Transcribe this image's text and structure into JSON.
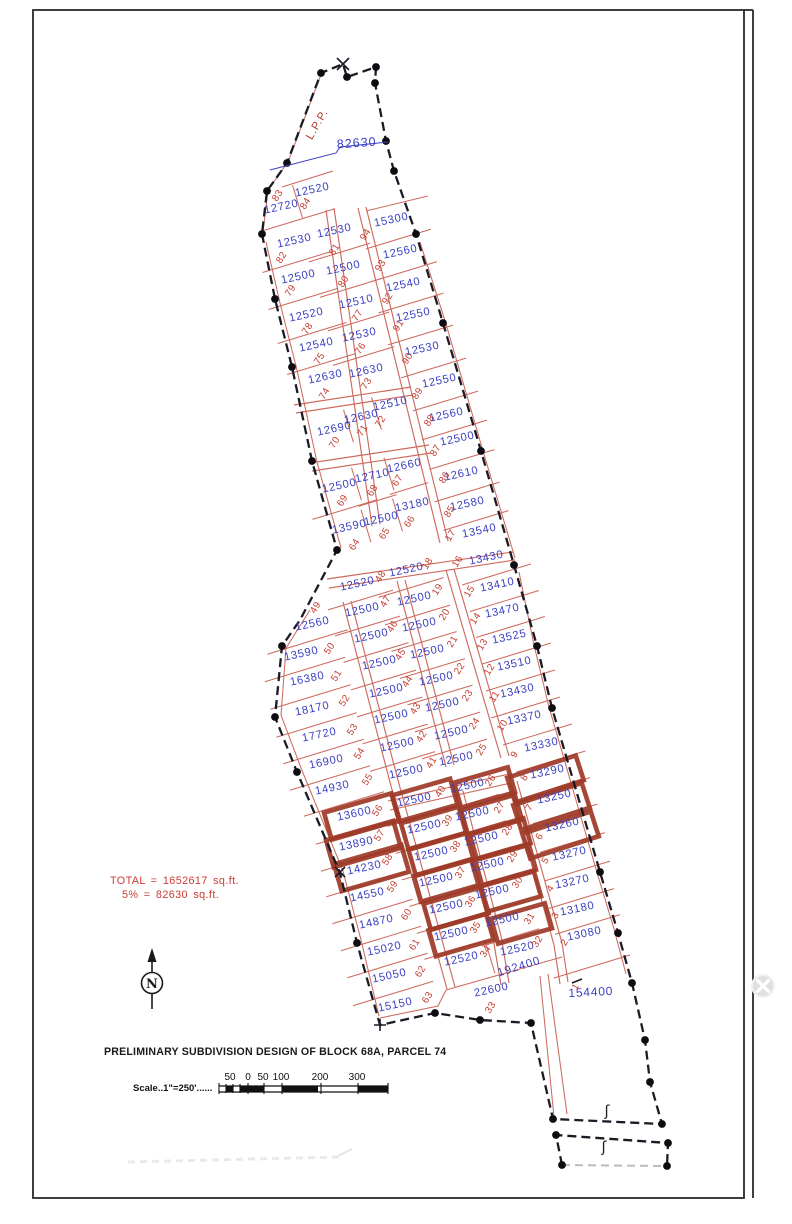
{
  "drawing": {
    "title": "PRELIMINARY  SUBDIVISION  DESIGN  OF  BLOCK  68A,  PARCEL  74",
    "scale_label": "Scale..1\"=250'......",
    "total_line1": "TOTAL  =  1652617  sq.ft.",
    "total_line2": "5%  =  82630  sq.ft.",
    "lpp_label": "L.P.P.",
    "top_area_label": "82630",
    "area_192400": "192400",
    "north_label": "N",
    "section_symbol": "ʃ"
  },
  "colors": {
    "lot_line": "#cd6a5e",
    "area_text": "#3a3fc1",
    "lot_num_text": "#c23b2e",
    "boundary": "#1b1b26",
    "dot": "#0d0d12",
    "highlight": "#9e3a28",
    "annotation_red": "#cc3b33",
    "title_text": "#1a1a1a",
    "leader_blue": "#3a3fc1"
  },
  "scale_bar": {
    "tick_labels": [
      [
        230,
        "50"
      ],
      [
        248,
        "0"
      ],
      [
        263,
        "50"
      ],
      [
        281,
        "100"
      ],
      [
        320,
        "200"
      ],
      [
        357,
        "300"
      ]
    ]
  },
  "highlight_groups": {
    "1": {
      "w": 70,
      "h": 28,
      "ox": -6,
      "oy": 2,
      "rot": -16
    },
    "2": {
      "w": 60,
      "h": 27,
      "ox": -4,
      "oy": 2,
      "rot": -16
    },
    "3": {
      "w": 56,
      "h": 26,
      "ox": 4,
      "oy": 2,
      "rot": -16
    },
    "4": {
      "w": 72,
      "h": 26,
      "ox": 8,
      "oy": 2,
      "rot": -18
    }
  },
  "lots": [
    [
      "83",
      "12720",
      282,
      210,
      280,
      197,
      0
    ],
    [
      "84",
      "12520",
      313,
      193,
      308,
      205,
      0
    ],
    [
      "94",
      "15300",
      392,
      223,
      368,
      236,
      0
    ],
    [
      "81",
      "12530",
      335,
      234,
      337,
      251,
      0
    ],
    [
      "82",
      "12530",
      295,
      244,
      284,
      259,
      0
    ],
    [
      "93",
      "12560",
      401,
      255,
      383,
      267,
      0
    ],
    [
      "80",
      "12500",
      344,
      271,
      346,
      283,
      0
    ],
    [
      "79",
      "12500",
      299,
      280,
      293,
      292,
      0
    ],
    [
      "92",
      "12540",
      404,
      288,
      390,
      300,
      0
    ],
    [
      "77",
      "12510",
      357,
      305,
      360,
      317,
      0
    ],
    [
      "78",
      "12520",
      307,
      318,
      310,
      330,
      0
    ],
    [
      "91",
      "12550",
      414,
      318,
      401,
      327,
      0
    ],
    [
      "76",
      "12530",
      360,
      338,
      363,
      350,
      0
    ],
    [
      "75",
      "12540",
      317,
      348,
      322,
      360,
      0
    ],
    [
      "90",
      "12530",
      423,
      352,
      410,
      360,
      0
    ],
    [
      "73",
      "12630",
      367,
      374,
      369,
      385,
      0
    ],
    [
      "74",
      "12630",
      326,
      380,
      327,
      395,
      0
    ],
    [
      "89",
      "12550",
      440,
      384,
      420,
      395,
      0
    ],
    [
      "72",
      "12510",
      391,
      407,
      383,
      423,
      0
    ],
    [
      "71",
      "12630",
      362,
      420,
      365,
      432,
      0
    ],
    [
      "70",
      "12690",
      335,
      432,
      337,
      444,
      0
    ],
    [
      "88",
      "12560",
      447,
      418,
      432,
      422,
      0
    ],
    [
      "87",
      "12500",
      458,
      442,
      438,
      452,
      0
    ],
    [
      "67",
      "12660",
      405,
      469,
      400,
      482,
      0
    ],
    [
      "68",
      "12710",
      373,
      479,
      375,
      492,
      0
    ],
    [
      "86",
      "12610",
      462,
      477,
      447,
      479,
      0
    ],
    [
      "69",
      "12500",
      340,
      489,
      345,
      502,
      0
    ],
    [
      "85",
      "12580",
      468,
      507,
      452,
      513,
      0
    ],
    [
      "66",
      "13180",
      413,
      508,
      412,
      523,
      0
    ],
    [
      "65",
      "12500",
      382,
      522,
      387,
      535,
      0
    ],
    [
      "64",
      "13590",
      350,
      530,
      357,
      546,
      0
    ],
    [
      "17",
      "13540",
      480,
      534,
      453,
      537,
      0
    ],
    [
      "16",
      "13430",
      487,
      561,
      460,
      563,
      0
    ],
    [
      "18",
      "12520",
      407,
      573,
      430,
      565,
      0
    ],
    [
      "48",
      "12520",
      358,
      587,
      383,
      578,
      0
    ],
    [
      "15",
      "13410",
      498,
      588,
      472,
      593,
      0
    ],
    [
      "19",
      "12500",
      415,
      602,
      440,
      591,
      0
    ],
    [
      "47",
      "12500",
      363,
      613,
      388,
      603,
      0
    ],
    [
      "14",
      "13470",
      503,
      614,
      478,
      620,
      0
    ],
    [
      "20",
      "12500",
      420,
      628,
      447,
      616,
      0
    ],
    [
      "46",
      "12500",
      372,
      639,
      395,
      628,
      0
    ],
    [
      "13",
      "13525",
      510,
      640,
      485,
      646,
      0
    ],
    [
      "21",
      "12500",
      428,
      655,
      455,
      643,
      0
    ],
    [
      "45",
      "12500",
      380,
      666,
      403,
      656,
      0
    ],
    [
      "12",
      "13510",
      515,
      667,
      492,
      671,
      0
    ],
    [
      "22",
      "12500",
      437,
      682,
      462,
      670,
      0
    ],
    [
      "44",
      "12500",
      387,
      694,
      410,
      683,
      0
    ],
    [
      "11",
      "13430",
      518,
      694,
      497,
      698,
      0
    ],
    [
      "23",
      "12500",
      443,
      708,
      470,
      697,
      0
    ],
    [
      "43",
      "12500",
      392,
      720,
      418,
      710,
      0
    ],
    [
      "10",
      "13370",
      525,
      721,
      505,
      727,
      0
    ],
    [
      "24",
      "12500",
      452,
      736,
      477,
      725,
      0
    ],
    [
      "42",
      "12500",
      398,
      748,
      424,
      738,
      0
    ],
    [
      "9",
      "13330",
      542,
      748,
      517,
      756,
      0
    ],
    [
      "25",
      "12500",
      457,
      762,
      484,
      751,
      0
    ],
    [
      "41",
      "12500",
      407,
      775,
      434,
      764,
      0
    ],
    [
      "49",
      "12560",
      313,
      627,
      318,
      609,
      0
    ],
    [
      "50",
      "13590",
      302,
      657,
      332,
      650,
      0
    ],
    [
      "51",
      "16380",
      308,
      682,
      339,
      677,
      0
    ],
    [
      "52",
      "18170",
      313,
      712,
      347,
      702,
      0
    ],
    [
      "53",
      "17720",
      320,
      738,
      355,
      731,
      0
    ],
    [
      "54",
      "16900",
      327,
      765,
      362,
      755,
      0
    ],
    [
      "55",
      "14930",
      333,
      791,
      370,
      781,
      0
    ],
    [
      "56",
      "13600",
      355,
      817,
      380,
      812,
      1
    ],
    [
      "57",
      "13890",
      357,
      847,
      382,
      837,
      1
    ],
    [
      "58",
      "14230",
      365,
      871,
      390,
      861,
      1
    ],
    [
      "59",
      "14550",
      368,
      898,
      395,
      888,
      0
    ],
    [
      "60",
      "14870",
      377,
      925,
      409,
      916,
      0
    ],
    [
      "61",
      "15020",
      385,
      952,
      417,
      946,
      0
    ],
    [
      "62",
      "15050",
      390,
      979,
      423,
      973,
      0
    ],
    [
      "63",
      "15150",
      396,
      1008,
      430,
      999,
      0
    ],
    [
      "40",
      "12500",
      415,
      803,
      443,
      793,
      2
    ],
    [
      "39",
      "12500",
      425,
      830,
      450,
      822,
      2
    ],
    [
      "38",
      "12500",
      432,
      857,
      458,
      848,
      2
    ],
    [
      "37",
      "12500",
      437,
      883,
      463,
      874,
      2
    ],
    [
      "36",
      "12500",
      447,
      910,
      473,
      903,
      2
    ],
    [
      "35",
      "12500",
      452,
      937,
      478,
      929,
      2
    ],
    [
      "26",
      "12500",
      468,
      789,
      493,
      782,
      3
    ],
    [
      "27",
      "12500",
      473,
      817,
      502,
      809,
      3
    ],
    [
      "28",
      "12500",
      482,
      842,
      510,
      831,
      3
    ],
    [
      "29",
      "12500",
      488,
      868,
      515,
      858,
      3
    ],
    [
      "30",
      "12500",
      493,
      895,
      520,
      884,
      3
    ],
    [
      "31",
      "12500",
      503,
      923,
      532,
      920,
      3
    ],
    [
      "34",
      "12520",
      462,
      962,
      488,
      953,
      0
    ],
    [
      "32",
      "12520",
      518,
      952,
      540,
      943,
      0
    ],
    [
      "33",
      "22600",
      492,
      993,
      493,
      1009,
      0
    ],
    [
      "8",
      "13290",
      548,
      775,
      527,
      779,
      4
    ],
    [
      "7",
      "13250",
      555,
      800,
      532,
      809,
      4
    ],
    [
      "6",
      "13260",
      563,
      828,
      542,
      838,
      4
    ],
    [
      "5",
      "13270",
      570,
      857,
      548,
      862,
      0
    ],
    [
      "4",
      "13270",
      573,
      885,
      553,
      890,
      0
    ],
    [
      "3",
      "13180",
      578,
      912,
      558,
      917,
      0
    ],
    [
      "2",
      "13080",
      585,
      937,
      567,
      944,
      0
    ],
    [
      "1",
      "154400",
      591,
      996,
      578,
      988,
      0,
      {
        "asize": 12,
        "ar": -3,
        "nsize": 9
      }
    ]
  ],
  "division_chains": [
    {
      "lots": [
        "82",
        "79",
        "78",
        "75",
        "74"
      ],
      "half": 36,
      "ox": 0
    },
    {
      "lots": [
        "81",
        "80",
        "77",
        "76",
        "73"
      ],
      "half": 32,
      "ox": 0
    },
    {
      "lots": [
        "94",
        "93",
        "92",
        "91",
        "90",
        "89",
        "88",
        "87",
        "86",
        "85",
        "17"
      ],
      "half": 34,
      "ox": 2
    },
    {
      "lots": [
        "69",
        "64"
      ],
      "half": 34,
      "ox": 0
    },
    {
      "lots": [
        "68",
        "65"
      ],
      "half": 20,
      "ox": 0
    },
    {
      "lots": [
        "67",
        "66"
      ],
      "half": 20,
      "ox": 0
    },
    {
      "lots": [
        "48",
        "47",
        "46",
        "45",
        "44",
        "43",
        "42",
        "41"
      ],
      "half": 34,
      "ox": 0
    },
    {
      "lots": [
        "18",
        "19",
        "20",
        "21",
        "22",
        "23",
        "24",
        "25"
      ],
      "half": 34,
      "ox": 0
    },
    {
      "lots": [
        "16",
        "15",
        "14",
        "13",
        "12",
        "11",
        "10",
        "9"
      ],
      "half": 36,
      "ox": 4
    },
    {
      "lots": [
        "9",
        "8"
      ],
      "half": 36,
      "ox": 6
    },
    {
      "lots": [
        "8",
        "7",
        "6",
        "5",
        "4",
        "3",
        "2"
      ],
      "half": 34,
      "ox": 6
    },
    {
      "lots": [
        "2",
        "1"
      ],
      "half": 40,
      "ox": 4
    },
    {
      "lots": [
        "49",
        "50",
        "51",
        "52",
        "53",
        "54",
        "55",
        "56",
        "57",
        "58",
        "59",
        "60",
        "61",
        "62",
        "63"
      ],
      "half": 42,
      "ox": 0
    },
    {
      "lots": [
        "40",
        "39",
        "38",
        "37",
        "36",
        "35",
        "34"
      ],
      "half": 34,
      "ox": 0
    },
    {
      "lots": [
        "26",
        "27",
        "28",
        "29",
        "30",
        "31",
        "32"
      ],
      "half": 30,
      "ox": 0
    }
  ],
  "pair_divisions": [
    [
      "83",
      "84"
    ],
    [
      "70",
      "71"
    ],
    [
      "71",
      "72"
    ],
    [
      "69",
      "68"
    ],
    [
      "68",
      "67"
    ],
    [
      "64",
      "65"
    ],
    [
      "65",
      "66"
    ],
    [
      "34",
      "32"
    ]
  ],
  "geometry": {
    "boundary_main": [
      [
        262,
        234
      ],
      [
        275,
        299
      ],
      [
        292,
        367
      ],
      [
        312,
        461
      ],
      [
        337,
        550
      ],
      [
        300,
        620
      ],
      [
        282,
        646
      ],
      [
        275,
        717
      ],
      [
        297,
        772
      ],
      [
        340,
        873
      ],
      [
        357,
        943
      ],
      [
        380,
        1025
      ],
      [
        435,
        1013
      ],
      [
        480,
        1020
      ],
      [
        531,
        1023
      ],
      [
        553,
        1119
      ],
      [
        662,
        1124
      ],
      [
        650,
        1082
      ],
      [
        645,
        1040
      ],
      [
        632,
        983
      ],
      [
        618,
        933
      ],
      [
        600,
        872
      ],
      [
        552,
        708
      ],
      [
        537,
        646
      ],
      [
        514,
        565
      ],
      [
        481,
        451
      ],
      [
        443,
        323
      ],
      [
        416,
        234
      ],
      [
        394,
        171
      ],
      [
        386,
        141
      ],
      [
        375,
        83
      ],
      [
        376,
        67
      ],
      [
        347,
        77
      ],
      [
        343,
        64
      ],
      [
        321,
        73
      ],
      [
        287,
        163
      ],
      [
        267,
        191
      ]
    ],
    "boundary_strip_dark": [
      [
        562,
        1165
      ],
      [
        556,
        1135
      ],
      [
        668,
        1143
      ],
      [
        667,
        1166
      ]
    ],
    "boundary_strip_gray": [
      [
        562,
        1165
      ],
      [
        667,
        1166
      ]
    ],
    "dots": [
      [
        262,
        234
      ],
      [
        267,
        191
      ],
      [
        287,
        163
      ],
      [
        321,
        73
      ],
      [
        347,
        77
      ],
      [
        376,
        67
      ],
      [
        375,
        83
      ],
      [
        386,
        141
      ],
      [
        394,
        171
      ],
      [
        416,
        234
      ],
      [
        443,
        323
      ],
      [
        481,
        451
      ],
      [
        514,
        565
      ],
      [
        537,
        646
      ],
      [
        552,
        708
      ],
      [
        600,
        872
      ],
      [
        618,
        933
      ],
      [
        632,
        983
      ],
      [
        645,
        1040
      ],
      [
        650,
        1082
      ],
      [
        662,
        1124
      ],
      [
        275,
        299
      ],
      [
        292,
        367
      ],
      [
        312,
        461
      ],
      [
        337,
        550
      ],
      [
        282,
        646
      ],
      [
        275,
        717
      ],
      [
        297,
        772
      ],
      [
        357,
        943
      ],
      [
        435,
        1013
      ],
      [
        480,
        1020
      ],
      [
        531,
        1023
      ],
      [
        553,
        1119
      ],
      [
        556,
        1135
      ],
      [
        668,
        1143
      ],
      [
        562,
        1165
      ],
      [
        667,
        1166
      ]
    ],
    "streets": [
      "M326,210 L372,526",
      "M334,208 L380,524",
      "M358,208 L440,543",
      "M366,207 L448,541",
      "M294,405 L411,387",
      "M296,413 L413,395",
      "M310,463 L429,445",
      "M312,471 L431,453",
      "M327,579 L513,552",
      "M329,588 L515,560",
      "M397,581 L446,767",
      "M405,580 L454,765",
      "M343,602 L391,786 L447,989",
      "M351,601 L399,784 L455,987",
      "M455,793 L493,938 L501,985",
      "M463,791 L501,936 L509,983",
      "M446,570 L501,758",
      "M454,569 L509,756",
      "M509,783 L554,945 L560,984",
      "M517,781 L562,943 L568,982",
      "M388,801 L509,774",
      "M390,810 L511,783"
    ],
    "extra_red_lines": [
      "M266,242 L280,303 L297,370 L317,462 L341,548",
      "M420,242 L446,324 L483,451 L515,558",
      "M310,610 L286,648 L281,715 L301,768 L343,871 L361,940 L379,1016",
      "M519,572 L534,645 L549,707 L596,869 L614,929 L626,974",
      "M380,1018 L438,1006 L446,990",
      "M282,187 L333,171",
      "M262,231 L334,209",
      "M366,211 L428,196",
      "M446,990 L562,957",
      "M540,976 L554,1117",
      "M548,974 L567,1114",
      "M263,232 L268,190 L288,162 L322,72"
    ],
    "leader_82630": [
      [
        270,
        170
      ],
      [
        336,
        153
      ],
      [
        340,
        147
      ],
      [
        388,
        142
      ]
    ]
  }
}
